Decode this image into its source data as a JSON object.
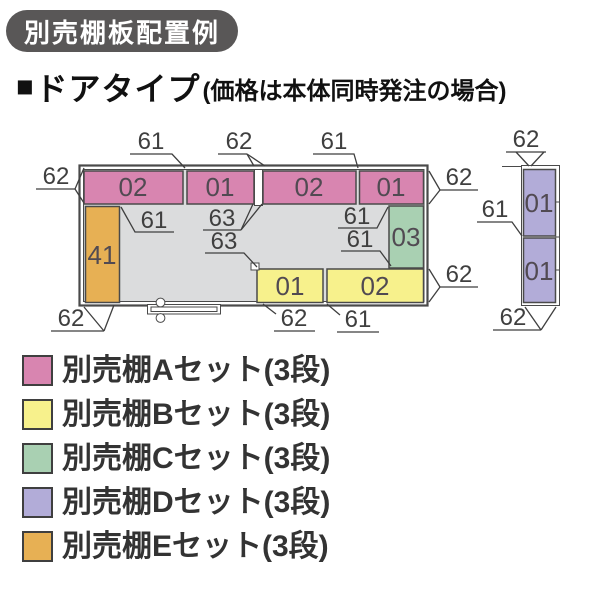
{
  "badge": {
    "label": "別売棚板配置例"
  },
  "heading": {
    "bullet": "■",
    "title": "ドアタイプ",
    "note": "(価格は本体同時発注の場合)"
  },
  "colors": {
    "set_a": "#d885b0",
    "set_b": "#f7f18c",
    "set_c": "#a9d0b2",
    "set_d": "#b2acd8",
    "set_e": "#e7b054",
    "floor": "#dbdcdd",
    "line": "#4a4a4a",
    "dim_text": "#3f3f3f",
    "shelf_text": "#514a52",
    "badge_bg": "#595757",
    "badge_text": "#ffffff"
  },
  "diagram": {
    "plan_shelves": [
      {
        "label": "02",
        "set": "A"
      },
      {
        "label": "01",
        "set": "A"
      },
      {
        "label": "02",
        "set": "A"
      },
      {
        "label": "01",
        "set": "A"
      },
      {
        "label": "41",
        "set": "E"
      },
      {
        "label": "03",
        "set": "C"
      },
      {
        "label": "01",
        "set": "B"
      },
      {
        "label": "02",
        "set": "B"
      },
      {
        "label": "01",
        "set": "D"
      },
      {
        "label": "01",
        "set": "D"
      }
    ],
    "dim_labels": [
      "61",
      "62",
      "61",
      "62",
      "62",
      "61",
      "63",
      "61",
      "63",
      "61",
      "62",
      "62",
      "61",
      "62",
      "61",
      "62",
      "62"
    ]
  },
  "legend": {
    "items": [
      {
        "set": "A",
        "label": "別売棚Aセット(3段)"
      },
      {
        "set": "B",
        "label": "別売棚Bセット(3段)"
      },
      {
        "set": "C",
        "label": "別売棚Cセット(3段)"
      },
      {
        "set": "D",
        "label": "別売棚Dセット(3段)"
      },
      {
        "set": "E",
        "label": "別売棚Eセット(3段)"
      }
    ]
  }
}
